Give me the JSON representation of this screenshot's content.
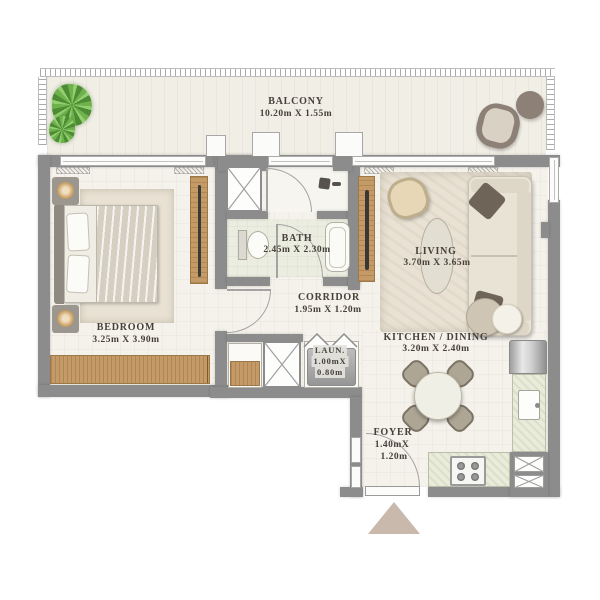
{
  "title": "Apartment floor plan",
  "rooms": {
    "balcony": {
      "name": "BALCONY",
      "dims": "10.20m X 1.55m"
    },
    "bedroom": {
      "name": "BEDROOM",
      "dims": "3.25m X 3.90m"
    },
    "bath": {
      "name": "BATH",
      "dims": "2.45m X 2.30m"
    },
    "corridor": {
      "name": "CORRIDOR",
      "dims": "1.95m X 1.20m"
    },
    "laundry": {
      "name": "LAUN.",
      "dims1": "1.00mX",
      "dims2": "0.80m"
    },
    "living": {
      "name": "LIVING",
      "dims": "3.70m X 3.65m"
    },
    "kitchen_dining": {
      "name": "KITCHEN / DINING",
      "dims": "3.20m X 2.40m"
    },
    "foyer": {
      "name": "FOYER",
      "dims1": "1.40mX",
      "dims2": "1.20m"
    }
  },
  "colors": {
    "wall": "#8c8c8c",
    "floor": "#f5f2eb",
    "balconyfloor": "#f1eee6",
    "bathfloor": "#ecede1",
    "counter": "#e9ecda",
    "wood": "#c49a67",
    "text": "#45403a",
    "triangle": "#c9b8ac",
    "sofa": "#e9e3d5",
    "cushion": "#6e6458",
    "rug": "#e9e2d4",
    "plant": "#5f9e41",
    "washer": "#a8a8a8",
    "taupe": "#8d8076"
  }
}
